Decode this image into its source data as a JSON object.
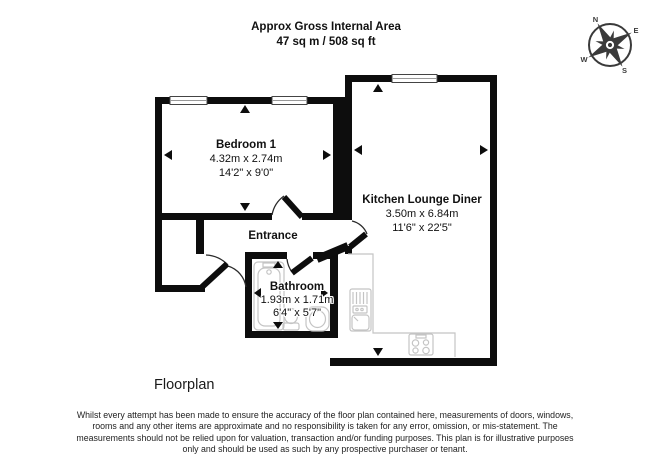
{
  "header": {
    "line1": "Approx Gross Internal Area",
    "line2": "47 sq m / 508 sq ft"
  },
  "compass": {
    "n": "N",
    "e": "E",
    "s": "S",
    "w": "W"
  },
  "rooms": {
    "bedroom": {
      "name": "Bedroom 1",
      "metric": "4.32m x 2.74m",
      "imperial": "14'2\" x 9'0\""
    },
    "kitchen": {
      "name": "Kitchen Lounge Diner",
      "metric": "3.50m x 6.84m",
      "imperial": "11'6\" x 22'5\""
    },
    "bathroom": {
      "name": "Bathroom",
      "metric": "1.93m x 1.71m",
      "imperial": "6'4\" x 5'7\""
    },
    "entrance": {
      "name": "Entrance"
    }
  },
  "footer": {
    "caption": "Floorplan",
    "disclaimer": "Whilst every attempt has been made to ensure the accuracy of the floor plan contained here, measurements of doors, windows, rooms and any other items are approximate and no responsibility is taken for any error, omission, or mis-statement. The measurements should not be relied upon for valuation, transaction and/or funding purposes. This plan is for illustrative purposes only and should be used as such by any prospective purchaser or tenant."
  },
  "colors": {
    "wall": "#0d0d0d",
    "fixture": "#c4c4c4",
    "compass": "#3a3a3a"
  }
}
